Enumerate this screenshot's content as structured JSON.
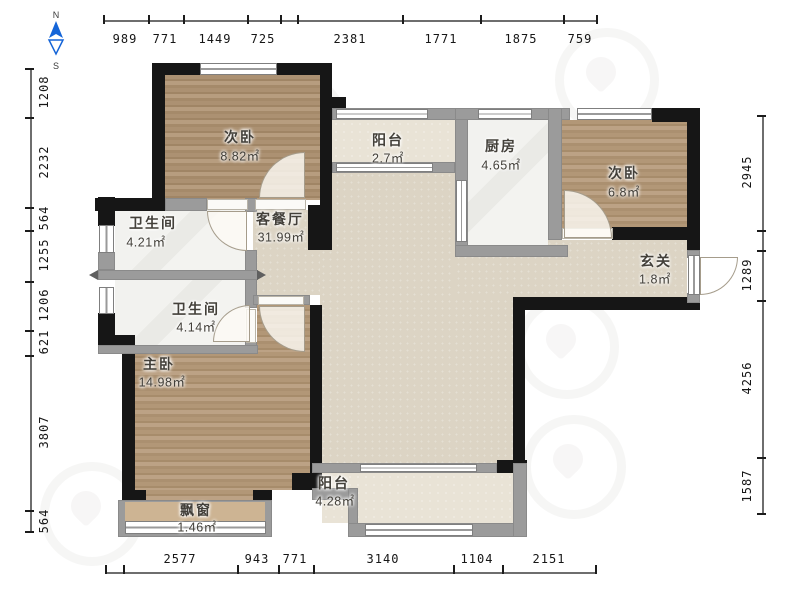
{
  "compass": {
    "north": "N",
    "south": "S"
  },
  "rooms": {
    "bedroom_nw": {
      "name": "次卧",
      "area": "8.82㎡"
    },
    "balcony_north": {
      "name": "阳台",
      "area": "2.7㎡"
    },
    "kitchen": {
      "name": "厨房",
      "area": "4.65㎡"
    },
    "bedroom_ne": {
      "name": "次卧",
      "area": "6.8㎡"
    },
    "living_dining": {
      "name": "客餐厅",
      "area": "31.99㎡"
    },
    "bathroom_upper": {
      "name": "卫生间",
      "area": "4.21㎡"
    },
    "bathroom_lower": {
      "name": "卫生间",
      "area": "4.14㎡"
    },
    "entry": {
      "name": "玄关",
      "area": "1.8㎡"
    },
    "bedroom_master": {
      "name": "主卧",
      "area": "14.98㎡"
    },
    "bay_window": {
      "name": "飘窗",
      "area": "1.46㎡"
    },
    "balcony_south": {
      "name": "阳台",
      "area": "4.28㎡"
    }
  },
  "dimensions_mm": {
    "top": [
      "989",
      "771",
      "1449",
      "725",
      "2381",
      "1771",
      "1875",
      "759"
    ],
    "bottom": [
      "2577",
      "943",
      "771",
      "3140",
      "1104",
      "2151"
    ],
    "left": [
      "1208",
      "2232",
      "564",
      "1255",
      "1206",
      "621",
      "3807",
      "564"
    ],
    "right": [
      "2945",
      "1289",
      "4256",
      "1587"
    ]
  },
  "colors": {
    "wall_bearing": "#161616",
    "wall_light": "#9b9b9b",
    "wood_floor": "#b19373",
    "living_floor": "#dcd4c4",
    "balcony_floor": "#e9e3d6",
    "marble_floor": "#f1f1ee",
    "compass_blue": "#1565d8"
  }
}
